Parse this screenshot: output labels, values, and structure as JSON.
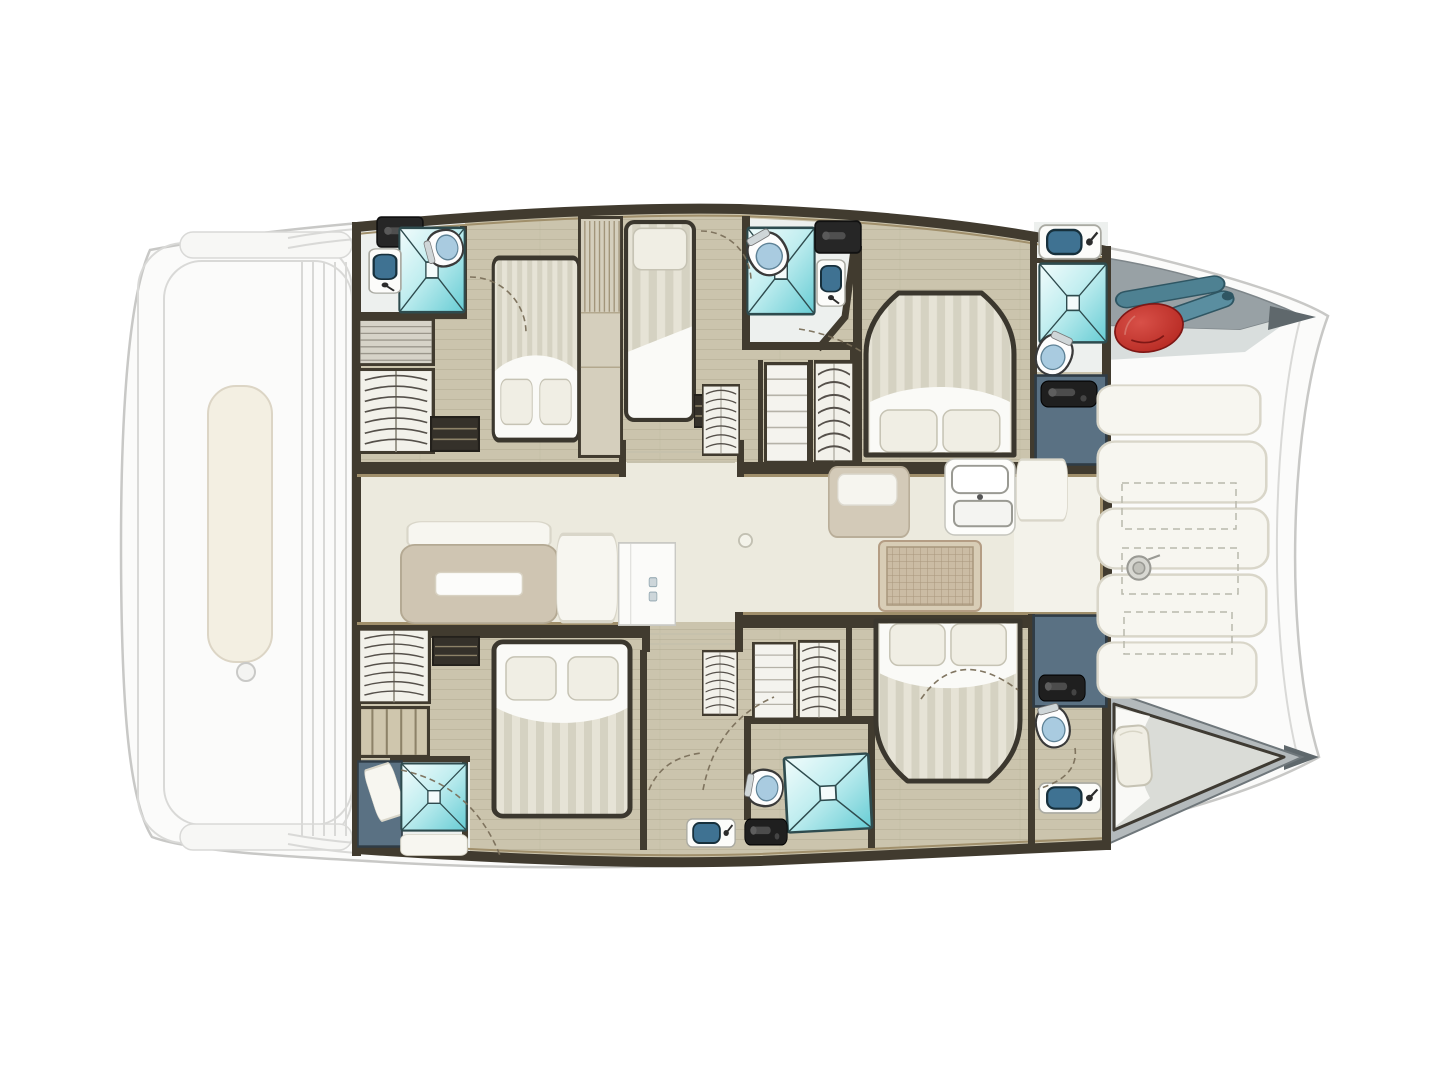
{
  "meta": {
    "description": "Top-down interior layout plan of a sailing catamaran: five cabins with beds, shower rooms with toilets and sinks, central salon with galley, forward cockpit bench seating, foredeck with fenders, faded aft deck",
    "orientation": {
      "bow": "right",
      "stern": "left"
    }
  },
  "inventory": {
    "rooms": [
      {
        "id": "salon",
        "label": "Salon and galley",
        "features": [
          "sofa",
          "dining table",
          "bench seat",
          "refrigerator",
          "nav seat",
          "double sink",
          "stove"
        ]
      },
      {
        "id": "port-aft-cabin",
        "label": "Port aft double cabin",
        "features": [
          "double bed",
          "wardrobe",
          "ensuite shower room"
        ]
      },
      {
        "id": "port-mid-cabin",
        "label": "Port single cabin",
        "features": [
          "single bed",
          "ensuite shower room"
        ]
      },
      {
        "id": "port-forward-cabin",
        "label": "Port forward double cabin",
        "features": [
          "island double bed",
          "ensuite shower room",
          "storage"
        ]
      },
      {
        "id": "starboard-aft-cabin",
        "label": "Starboard aft double cabin",
        "features": [
          "double bed",
          "wardrobe",
          "shower room"
        ]
      },
      {
        "id": "starboard-forward-cabin",
        "label": "Starboard forward double cabin",
        "features": [
          "island double bed",
          "ensuite shower room"
        ]
      },
      {
        "id": "forepeak-berth",
        "label": "Starboard forepeak berth",
        "features": [
          "single berth",
          "pillow"
        ]
      },
      {
        "id": "forward-cockpit",
        "label": "Forward cockpit",
        "features": [
          "bench seats",
          "storage lockers",
          "windlass"
        ]
      },
      {
        "id": "foredeck",
        "label": "Port foredeck",
        "features": [
          "red fender",
          "boat hooks"
        ]
      },
      {
        "id": "aft-deck",
        "label": "Aft deck (faded)",
        "features": [
          "bench",
          "deck lines"
        ]
      }
    ],
    "counts": {
      "double_beds": 4,
      "single_beds": 2,
      "showers": 5,
      "toilets": 5,
      "sinks": 6
    }
  },
  "colors": {
    "hull_fill": "#fbfbfa",
    "hull_line": "#c8c8c6",
    "deck_faded": "#d9d9d7",
    "bench_cream": "#f3efe2",
    "floor_wood": "#cbc4ad",
    "floor_plank_line": "#b1aa92",
    "floor_salon": "#eceade",
    "floor_galley": "#f3f2ea",
    "wall_dark": "#413b2f",
    "wall_tan": "#a08f6b",
    "shower_teal_light": "#f2fcfc",
    "shower_teal_mid": "#c2eef0",
    "shower_teal": "#66ccd4",
    "shower_line": "#2e4b4e",
    "toilet_seat_blue": "#a9cbe0",
    "sink_basin_blue": "#3f7292",
    "slate_blue": "#5a7183",
    "handle_black": "#1f1f1f",
    "bed_stripe_a": "#e6e3d6",
    "bed_stripe_b": "#d5d2c2",
    "bed_white": "#fafaf7",
    "bed_frame": "#3b372e",
    "pillow": "#f0eee4",
    "table_beige": "#cfc5b2",
    "seat_white": "#f7f6f0",
    "stove_frame": "#d8cdb6",
    "stove_grid_bg": "#cbbca4",
    "stove_grid_line": "#a8967c",
    "cockpit_panel": "#f4f3ec",
    "cockpit_panel_line": "#d9d8cc",
    "dash_line": "#b9b8ac",
    "foredeck_gray": "#98a1a5",
    "foredeck_trim": "#d9dedd",
    "foredeck_edge": "#7e868a",
    "fender_red": "#b3261f",
    "fender_red_dark": "#7e1715",
    "paddle_teal": "#4e8192",
    "paddle_teal_dark": "#2f5663",
    "berth_mattress": "#dadcd7",
    "arc_color": "#7a6f5a"
  },
  "symbols": {
    "shower": {
      "w": 100,
      "h": 100
    },
    "toilet": {
      "w": 44,
      "h": 56
    },
    "sink": {
      "w": 56,
      "h": 30
    },
    "galley-sink": {
      "w": 72,
      "h": 80
    },
    "hanging-locker": {
      "w": 70,
      "h": 85
    },
    "wardrobe-tall": {
      "w": 46,
      "h": 240
    },
    "shelf-gray": {
      "w": 70,
      "h": 50
    },
    "shelf-tan": {
      "w": 70,
      "h": 50
    },
    "shelf-white": {
      "w": 46,
      "h": 95
    },
    "steps": {
      "w": 48,
      "h": 34
    },
    "counter-dark": {
      "w": 44,
      "h": 28
    },
    "handle-plate": {
      "w": 56,
      "h": 26
    },
    "slate": {
      "w": 70,
      "h": 90
    },
    "bed-double": {
      "w": 140,
      "h": 190
    },
    "bed-island": {
      "w": 150,
      "h": 168
    },
    "bed-single": {
      "w": 70,
      "h": 195
    },
    "panel-white": {
      "w": 100,
      "h": 40
    },
    "seat-nav": {
      "w": 100,
      "h": 70
    },
    "table-salon": {
      "w": 160,
      "h": 90
    },
    "fridge": {
      "w": 82,
      "h": 94
    },
    "stove": {
      "w": 104,
      "h": 72
    },
    "circle-knob": {
      "w": 16,
      "h": 16
    },
    "winch": {
      "w": 40,
      "h": 30
    },
    "fender-red": {
      "w": 86,
      "h": 64
    },
    "paddles": {
      "w": 130,
      "h": 76
    },
    "pillow": {
      "w": 40,
      "h": 62
    }
  },
  "fixtures": [
    {
      "name": "port-aft-bath-counter",
      "type": "counter-dark",
      "x": 376,
      "y": 216,
      "w": 48,
      "h": 32,
      "rot": 0
    },
    {
      "name": "port-aft-bath-shower",
      "type": "shower",
      "x": 398,
      "y": 226,
      "w": 68,
      "h": 88,
      "rot": 0
    },
    {
      "name": "port-aft-bath-sink",
      "type": "sink",
      "x": 362,
      "y": 254,
      "w": 46,
      "h": 34,
      "rot": 90
    },
    {
      "name": "port-aft-bath-toilet",
      "type": "toilet",
      "x": 424,
      "y": 228,
      "w": 42,
      "h": 40,
      "rot": -105
    },
    {
      "name": "port-aft-shelf",
      "type": "shelf-gray",
      "x": 357,
      "y": 318,
      "w": 78,
      "h": 48,
      "rot": 0
    },
    {
      "name": "port-aft-hanging-locker",
      "type": "hanging-locker",
      "x": 357,
      "y": 368,
      "w": 78,
      "h": 86,
      "rot": 0
    },
    {
      "name": "port-aft-steps",
      "type": "steps",
      "x": 430,
      "y": 416,
      "w": 50,
      "h": 36,
      "rot": 0
    },
    {
      "name": "port-aft-bed",
      "type": "bed-double",
      "x": 492,
      "y": 256,
      "w": 88,
      "h": 186,
      "rot": 0
    },
    {
      "name": "port-cabin-divider-wardrobe",
      "type": "wardrobe-tall",
      "x": 578,
      "y": 216,
      "w": 45,
      "h": 242,
      "rot": 0
    },
    {
      "name": "port-mid-bed",
      "type": "bed-single",
      "x": 624,
      "y": 220,
      "w": 72,
      "h": 202,
      "rot": 0
    },
    {
      "name": "port-mid-bedside",
      "type": "steps",
      "x": 694,
      "y": 394,
      "w": 20,
      "h": 34,
      "rot": 0
    },
    {
      "name": "port-mid-bath-shower",
      "type": "shower",
      "x": 746,
      "y": 226,
      "w": 70,
      "h": 90,
      "rot": 0
    },
    {
      "name": "port-mid-bath-toilet",
      "type": "toilet",
      "x": 746,
      "y": 230,
      "w": 44,
      "h": 48,
      "rot": -30
    },
    {
      "name": "port-mid-bath-sink",
      "type": "sink",
      "x": 807,
      "y": 268,
      "w": 48,
      "h": 30,
      "rot": 90
    },
    {
      "name": "port-mid-bath-counter",
      "type": "counter-dark",
      "x": 814,
      "y": 220,
      "w": 48,
      "h": 34,
      "rot": 0
    },
    {
      "name": "port-corridor-hanging-locker",
      "type": "hanging-locker",
      "x": 702,
      "y": 384,
      "w": 38,
      "h": 72,
      "rot": 0
    },
    {
      "name": "port-corridor-shelf",
      "type": "shelf-white",
      "x": 764,
      "y": 362,
      "w": 46,
      "h": 102,
      "rot": 0
    },
    {
      "name": "port-corridor-hanging-locker-2",
      "type": "hanging-locker",
      "x": 814,
      "y": 360,
      "w": 40,
      "h": 104,
      "rot": 0
    },
    {
      "name": "port-fwd-bed",
      "type": "bed-island",
      "x": 864,
      "y": 290,
      "w": 152,
      "h": 168,
      "rot": 0
    },
    {
      "name": "port-fwd-bath-sink",
      "type": "sink",
      "x": 1038,
      "y": 224,
      "w": 64,
      "h": 36,
      "rot": 0
    },
    {
      "name": "port-fwd-bath-shower",
      "type": "shower",
      "x": 1038,
      "y": 262,
      "w": 70,
      "h": 82,
      "rot": 0
    },
    {
      "name": "port-fwd-bath-toilet",
      "type": "toilet",
      "x": 1034,
      "y": 332,
      "w": 40,
      "h": 46,
      "rot": 25
    },
    {
      "name": "port-fwd-storage",
      "type": "slate",
      "x": 1034,
      "y": 374,
      "w": 74,
      "h": 92,
      "rot": 0
    },
    {
      "name": "port-fwd-storage-handle",
      "type": "handle-plate",
      "x": 1040,
      "y": 380,
      "w": 58,
      "h": 28,
      "rot": 0
    },
    {
      "name": "salon-sofa-back",
      "type": "panel-white",
      "x": 406,
      "y": 521,
      "w": 146,
      "h": 28,
      "rot": 0
    },
    {
      "name": "salon-table",
      "type": "table-salon",
      "x": 400,
      "y": 544,
      "w": 158,
      "h": 80,
      "rot": 0
    },
    {
      "name": "salon-bench-seat",
      "type": "panel-white",
      "x": 556,
      "y": 532,
      "w": 62,
      "h": 92,
      "rot": 0
    },
    {
      "name": "salon-fridge",
      "type": "fridge",
      "x": 618,
      "y": 542,
      "w": 58,
      "h": 84,
      "rot": 0
    },
    {
      "name": "salon-pole",
      "type": "circle-knob",
      "x": 738,
      "y": 533,
      "w": 15,
      "h": 15,
      "rot": 0
    },
    {
      "name": "salon-nav-seat",
      "type": "seat-nav",
      "x": 828,
      "y": 466,
      "w": 82,
      "h": 72,
      "rot": 0
    },
    {
      "name": "galley-sink",
      "type": "galley-sink",
      "x": 944,
      "y": 458,
      "w": 72,
      "h": 78,
      "rot": 0
    },
    {
      "name": "galley-stove",
      "type": "stove",
      "x": 878,
      "y": 540,
      "w": 104,
      "h": 72,
      "rot": 0
    },
    {
      "name": "galley-cabinet",
      "type": "panel-white",
      "x": 1016,
      "y": 458,
      "w": 52,
      "h": 64,
      "rot": 0
    },
    {
      "name": "stbd-aft-hanging-locker",
      "type": "hanging-locker",
      "x": 357,
      "y": 628,
      "w": 74,
      "h": 76,
      "rot": 0
    },
    {
      "name": "stbd-aft-shelf",
      "type": "shelf-tan",
      "x": 358,
      "y": 706,
      "w": 72,
      "h": 52,
      "rot": 0
    },
    {
      "name": "stbd-aft-storage",
      "type": "slate",
      "x": 357,
      "y": 760,
      "w": 46,
      "h": 88,
      "rot": 0
    },
    {
      "name": "stbd-aft-door-panel",
      "type": "panel-white",
      "x": 370,
      "y": 764,
      "w": 30,
      "h": 56,
      "rot": -18
    },
    {
      "name": "stbd-aft-shower",
      "type": "shower",
      "x": 400,
      "y": 762,
      "w": 68,
      "h": 70,
      "rot": 0
    },
    {
      "name": "stbd-aft-counter",
      "type": "panel-white",
      "x": 400,
      "y": 834,
      "w": 68,
      "h": 22,
      "rot": 0
    },
    {
      "name": "stbd-aft-steps",
      "type": "steps",
      "x": 432,
      "y": 636,
      "w": 48,
      "h": 30,
      "rot": 0
    },
    {
      "name": "stbd-aft-bed",
      "type": "bed-double",
      "x": 492,
      "y": 640,
      "w": 140,
      "h": 178,
      "rot": 180
    },
    {
      "name": "stbd-corridor-hanging-locker",
      "type": "hanging-locker",
      "x": 702,
      "y": 650,
      "w": 36,
      "h": 66,
      "rot": 0
    },
    {
      "name": "stbd-corridor-shelf",
      "type": "shelf-white",
      "x": 752,
      "y": 642,
      "w": 44,
      "h": 78,
      "rot": 0
    },
    {
      "name": "stbd-corridor-hanging-locker-2",
      "type": "hanging-locker",
      "x": 798,
      "y": 640,
      "w": 42,
      "h": 80,
      "rot": 0
    },
    {
      "name": "stbd-mid-bath-shower",
      "type": "shower",
      "x": 784,
      "y": 754,
      "w": 88,
      "h": 78,
      "rot": -3
    },
    {
      "name": "stbd-mid-bath-toilet",
      "type": "toilet",
      "x": 744,
      "y": 768,
      "w": 42,
      "h": 40,
      "rot": -80
    },
    {
      "name": "stbd-mid-bath-sink",
      "type": "sink",
      "x": 686,
      "y": 818,
      "w": 50,
      "h": 30,
      "rot": 0
    },
    {
      "name": "stbd-mid-bath-door",
      "type": "handle-plate",
      "x": 744,
      "y": 818,
      "w": 44,
      "h": 28,
      "rot": 0
    },
    {
      "name": "stbd-fwd-bed",
      "type": "bed-island",
      "x": 874,
      "y": 618,
      "w": 148,
      "h": 166,
      "rot": 180
    },
    {
      "name": "stbd-fwd-storage",
      "type": "slate",
      "x": 1032,
      "y": 614,
      "w": 76,
      "h": 94,
      "rot": 0
    },
    {
      "name": "stbd-fwd-storage-handle",
      "type": "handle-plate",
      "x": 1038,
      "y": 674,
      "w": 48,
      "h": 28,
      "rot": 0
    },
    {
      "name": "stbd-fwd-bath-toilet",
      "type": "toilet",
      "x": 1034,
      "y": 704,
      "w": 38,
      "h": 46,
      "rot": -15
    },
    {
      "name": "stbd-fwd-bath-sink",
      "type": "sink",
      "x": 1038,
      "y": 782,
      "w": 64,
      "h": 32,
      "rot": 0
    },
    {
      "name": "cockpit-seat-1",
      "type": "panel-white",
      "x": 1096,
      "y": 384,
      "w": 166,
      "h": 52,
      "rot": 0
    },
    {
      "name": "cockpit-seat-2",
      "type": "panel-white",
      "x": 1096,
      "y": 440,
      "w": 172,
      "h": 64,
      "rot": 0
    },
    {
      "name": "cockpit-seat-3",
      "type": "panel-white",
      "x": 1096,
      "y": 507,
      "w": 174,
      "h": 63,
      "rot": 0
    },
    {
      "name": "cockpit-seat-4",
      "type": "panel-white",
      "x": 1096,
      "y": 573,
      "w": 172,
      "h": 65,
      "rot": 0
    },
    {
      "name": "cockpit-seat-5",
      "type": "panel-white",
      "x": 1096,
      "y": 641,
      "w": 162,
      "h": 58,
      "rot": 0
    },
    {
      "name": "cockpit-windlass",
      "type": "winch",
      "x": 1120,
      "y": 552,
      "w": 42,
      "h": 32,
      "rot": 0
    },
    {
      "name": "foredeck-paddles",
      "type": "paddles",
      "x": 1112,
      "y": 276,
      "w": 128,
      "h": 56,
      "rot": -4
    },
    {
      "name": "foredeck-fender",
      "type": "fender-red",
      "x": 1112,
      "y": 302,
      "w": 74,
      "h": 52,
      "rot": -12
    },
    {
      "name": "forepeak-pillow",
      "type": "pillow",
      "x": 1114,
      "y": 724,
      "w": 38,
      "h": 64,
      "rot": -5
    }
  ]
}
